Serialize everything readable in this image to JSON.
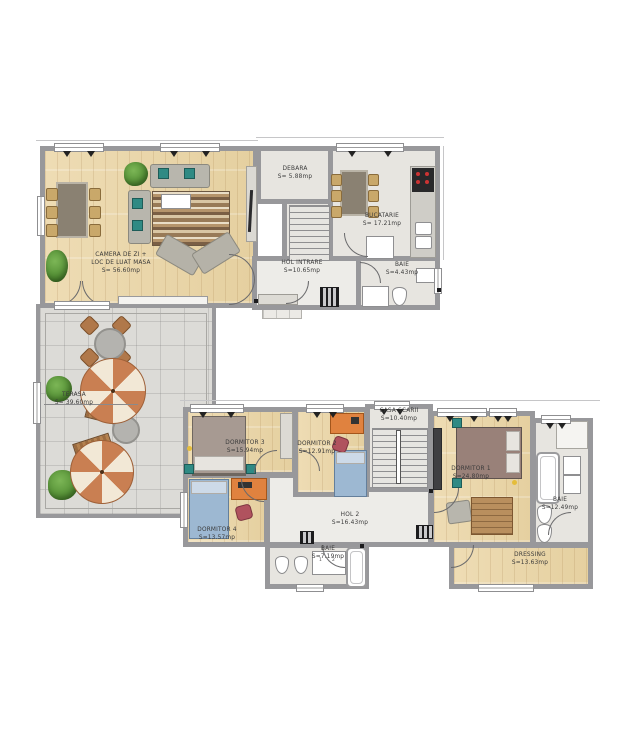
{
  "plan": {
    "ground": {
      "living": {
        "name": "CAMERA DE ZI +",
        "name2": "LOC DE LUAT MASA",
        "area": "S= 56.60mp"
      },
      "debara": {
        "name": "DEBARA",
        "area": "S= 5.88mp"
      },
      "bucatarie": {
        "name": "BUCATARIE",
        "area": "S= 17.21mp"
      },
      "hol": {
        "name": "HOL INTRARE",
        "area": "S=10.65mp"
      },
      "baie": {
        "name": "BAIE",
        "area": "S=4.43mp"
      },
      "terasa": {
        "name": "TERASA",
        "area": "S= 39.60mp"
      }
    },
    "etaj": {
      "dormitor1": {
        "name": "DORMITOR 1",
        "area": "S=24.80mp"
      },
      "dormitor2": {
        "name": "DORMITOR 2",
        "area": "S=12.91mp"
      },
      "dormitor3": {
        "name": "DORMITOR 3",
        "area": "S=15.94mp"
      },
      "dormitor4": {
        "name": "DORMITOR 4",
        "area": "S=13.57mp"
      },
      "casa_scarii": {
        "name": "CASA SCARII",
        "area": "S=10.40mp"
      },
      "hol2": {
        "name": "HOL 2",
        "area": "S=16.43mp"
      },
      "baie_mica": {
        "name": "BAIE",
        "area": "S=7.19mp"
      },
      "baie_mare": {
        "name": "BAIE",
        "area": "S=12.49mp"
      },
      "dressing": {
        "name": "DRESSING",
        "area": "S=13.63mp"
      }
    },
    "fixtures": {
      "vanity_left": "1",
      "vanity_right": "2"
    },
    "colors": {
      "wall": "#98989b",
      "wood": "#ecd9ae",
      "tile": "#e7e5e0",
      "terrace": "#dcdbd7",
      "accent_orange": "#e0823f",
      "bed_blue": "#9db8d2",
      "sofa_gray": "#b8b6ad",
      "umbrella": "#c97f52",
      "plant_green": "#5f9c3e"
    }
  }
}
